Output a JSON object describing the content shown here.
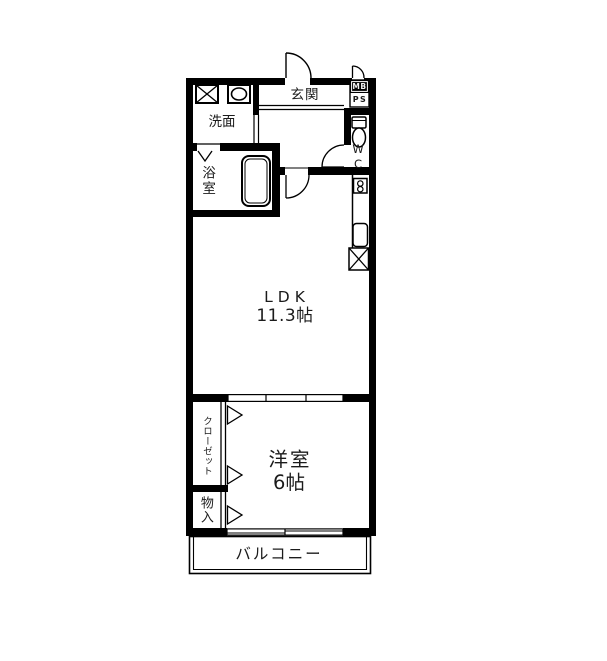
{
  "title": "floor-plan",
  "colors": {
    "wall": "#000000",
    "text": "#1b1b1b",
    "background": "#ffffff",
    "mb_box_fill": "#000000",
    "mb_text": "#f2f2f2"
  },
  "rooms": {
    "genkan": {
      "label": "玄関"
    },
    "senmen": {
      "label": "洗面"
    },
    "bathroom": {
      "label": "浴室"
    },
    "wc": {
      "label": "WC"
    },
    "mb": {
      "label": "MB"
    },
    "ps": {
      "label": "PS"
    },
    "ldk": {
      "label": "LDK",
      "size": "11.3帖"
    },
    "yoshitsu": {
      "label": "洋室",
      "size": "6帖"
    },
    "closet": {
      "label": "クローゼット"
    },
    "monoire": {
      "label": "物入"
    },
    "balcony": {
      "label": "バルコニー"
    }
  },
  "fixtures": [
    "washing-machine-icon",
    "vanity-sink-icon",
    "bathtub-icon",
    "toilet-icon",
    "stove-icon",
    "kitchen-sink-icon",
    "refrigerator-icon",
    "entry-door-arc",
    "mb-door-arc",
    "wc-door-arc",
    "ldk-door-arc",
    "bath-folding-door-icon",
    "closet-door-triangles",
    "sliding-partition",
    "balcony-window"
  ]
}
